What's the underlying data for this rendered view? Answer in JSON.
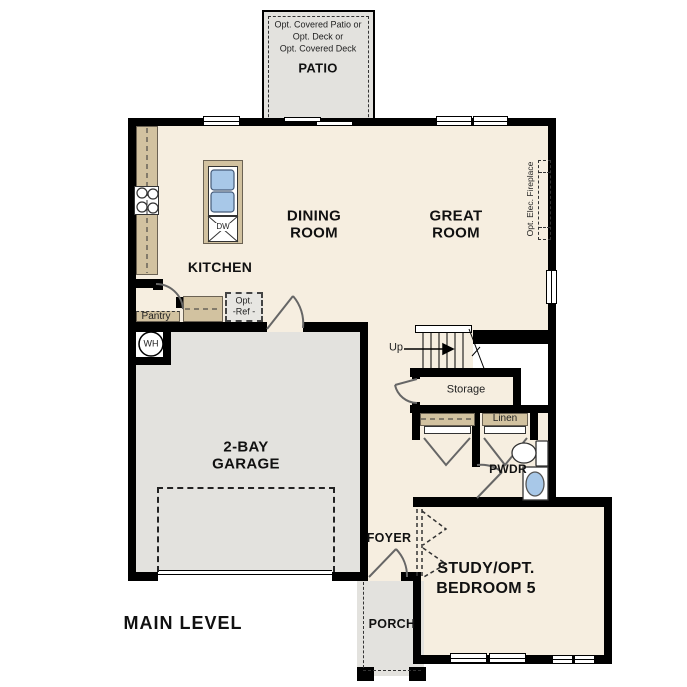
{
  "title": {
    "label": "MAIN LEVEL"
  },
  "colors": {
    "floor": "#f6eee0",
    "hardscape": "#e3e2de",
    "counter": "#d2c2a0",
    "wall": "#000000",
    "fixture_water": "#a8c8e8"
  },
  "patio": {
    "label": "PATIO",
    "notes": [
      "Opt. Covered Patio or",
      "Opt. Deck or",
      "Opt. Covered Deck"
    ]
  },
  "rooms": {
    "dining": {
      "lines": [
        "DINING",
        "ROOM"
      ]
    },
    "great": {
      "lines": [
        "GREAT",
        "ROOM"
      ]
    },
    "kitchen": {
      "label": "KITCHEN"
    },
    "garage": {
      "lines": [
        "2-BAY",
        "GARAGE"
      ]
    },
    "study": {
      "lines": [
        "STUDY/OPT.",
        "BEDROOM 5"
      ]
    },
    "foyer": {
      "label": "FOYER"
    },
    "porch": {
      "label": "PORCH"
    },
    "pwdr": {
      "label": "PWDR"
    },
    "storage": {
      "label": "Storage"
    },
    "linen": {
      "label": "Linen"
    },
    "pantry": {
      "label": "Pantry"
    }
  },
  "annotations": {
    "up": "Up",
    "wh": "WH",
    "dw": "DW",
    "opt_ref_lines": [
      "Opt.",
      "-Ref -"
    ],
    "fireplace": "Opt. Elec. Fireplace"
  }
}
